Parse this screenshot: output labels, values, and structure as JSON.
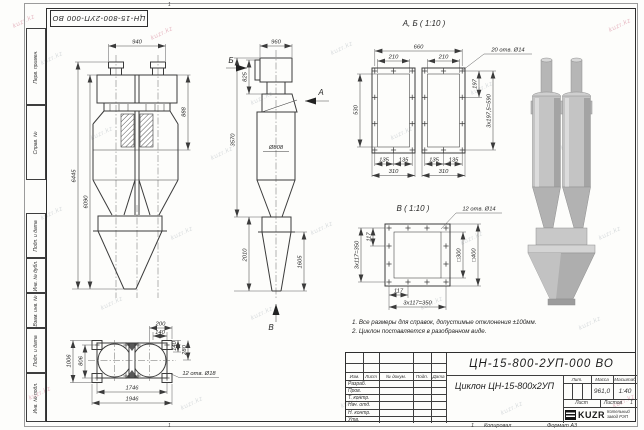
{
  "stamp": {
    "doc_number_top": "ЦН-15-800-2УП-000 ВО"
  },
  "watermark": {
    "text": "kuzr.kz"
  },
  "margin_labels": [
    "Перв. примен.",
    "Справ. №",
    "Подп. и дата",
    "Инв. № дубл.",
    "Взам. инв. №",
    "Подп. и дата",
    "Инв. № подл."
  ],
  "zones": {
    "top": "1",
    "bottom_left": "1",
    "bottom_center": "1"
  },
  "front_view": {
    "dim_top_width": "940",
    "dim_right_height": "888",
    "dim_total_height": "6445",
    "dim_inner_height": "6090"
  },
  "side_view": {
    "dim_top_width": "960",
    "dim_outlet_height": "825",
    "dim_body_height": "3570",
    "dim_diameter": "Ø808",
    "dim_hopper_height": "2010",
    "dim_cone_height": "1605",
    "arrow_a": "А",
    "arrow_b": "Б",
    "arrow_v": "В"
  },
  "view_ab": {
    "title": "А, Б ( 1:10 )",
    "holes_label": "20 отв. Ø14",
    "dim_overall": "660",
    "dim_opening": "210",
    "dim_height": "530",
    "dim_hole_pitch": "197",
    "dim_hole_span": "3x197,5=590",
    "dim_135": "135",
    "dim_310": "310"
  },
  "view_v": {
    "title": "В ( 1:10 )",
    "holes_label": "12 отв. Ø14",
    "dim_pitch": "117",
    "dim_span": "3x117=350",
    "dim_inner_square": "□300",
    "dim_outer_square": "□400"
  },
  "plan_view": {
    "holes_label": "12 отв. Ø18",
    "dim_200": "200",
    "dim_140_top": "140",
    "dim_140_right": "140",
    "dim_280": "280",
    "dim_outer_width": "1006",
    "dim_hole_width": "806",
    "dim_hole_length": "1746",
    "dim_outer_length": "1946"
  },
  "notes": [
    "1. Все размеры для справок, допустимые отклонения ±100мм.",
    "2. Циклон поставляется в разобранном виде."
  ],
  "title_block": {
    "doc_number": "ЦН-15-800-2УП-000 ВО",
    "product_title": "Циклон ЦН-15-800х2УП",
    "change_cols": [
      "Изм.",
      "Лист",
      "№ докум.",
      "Подп.",
      "Дата"
    ],
    "sign_rows": [
      "Разраб.",
      "Пров.",
      "Т. контр.",
      "Нач. отд.",
      "Н. контр.",
      "Утв."
    ],
    "lit_label": "Лит.",
    "mass_label": "Масса",
    "scale_label": "Масштаб",
    "mass_value": "961,0",
    "scale_value": "1:40",
    "sheet_label": "Лист",
    "sheets_label": "Листов",
    "sheets_value": "1",
    "company_logo": "KUZR",
    "company_name_line1": "Котельный",
    "company_name_line2": "завод РЭП",
    "copied_label": "Копировал",
    "format_label": "Формат А3"
  }
}
